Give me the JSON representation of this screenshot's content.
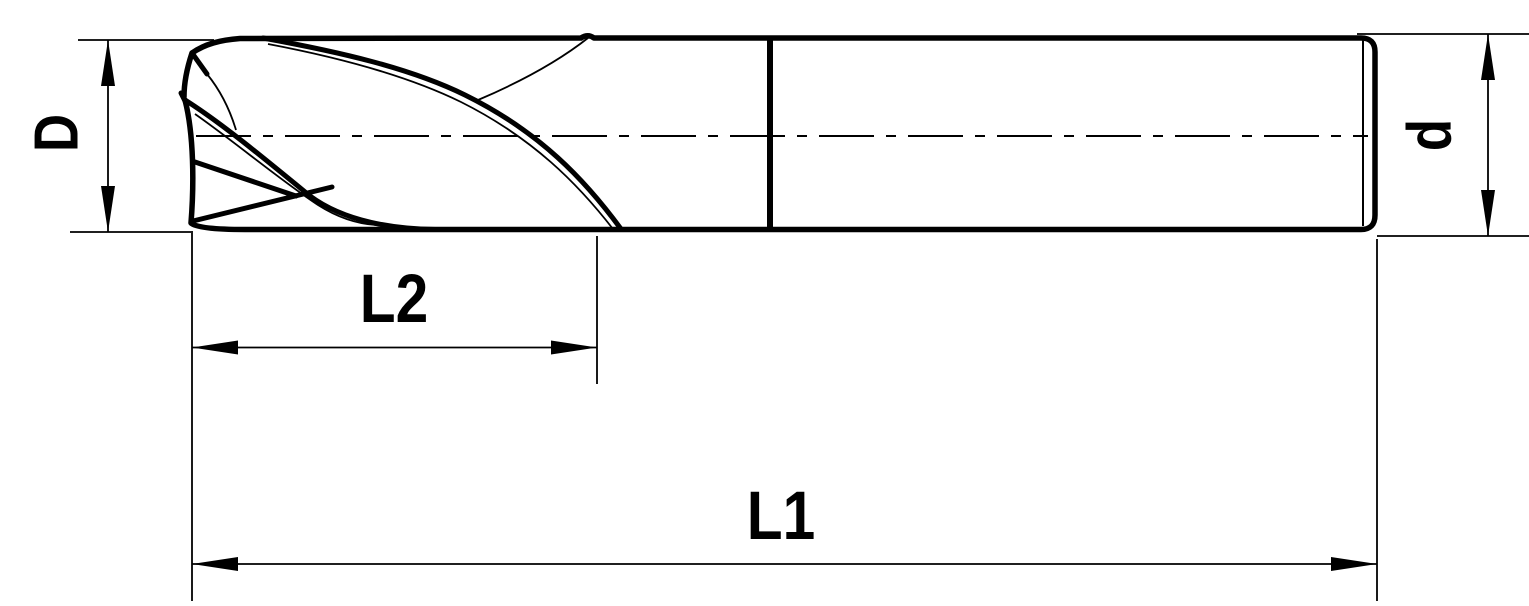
{
  "drawing": {
    "background_color": "#ffffff",
    "line_color": "#000000",
    "labels": {
      "cutter_diameter": "D",
      "shank_diameter": "d",
      "flute_length": "L2",
      "overall_length": "L1"
    }
  }
}
